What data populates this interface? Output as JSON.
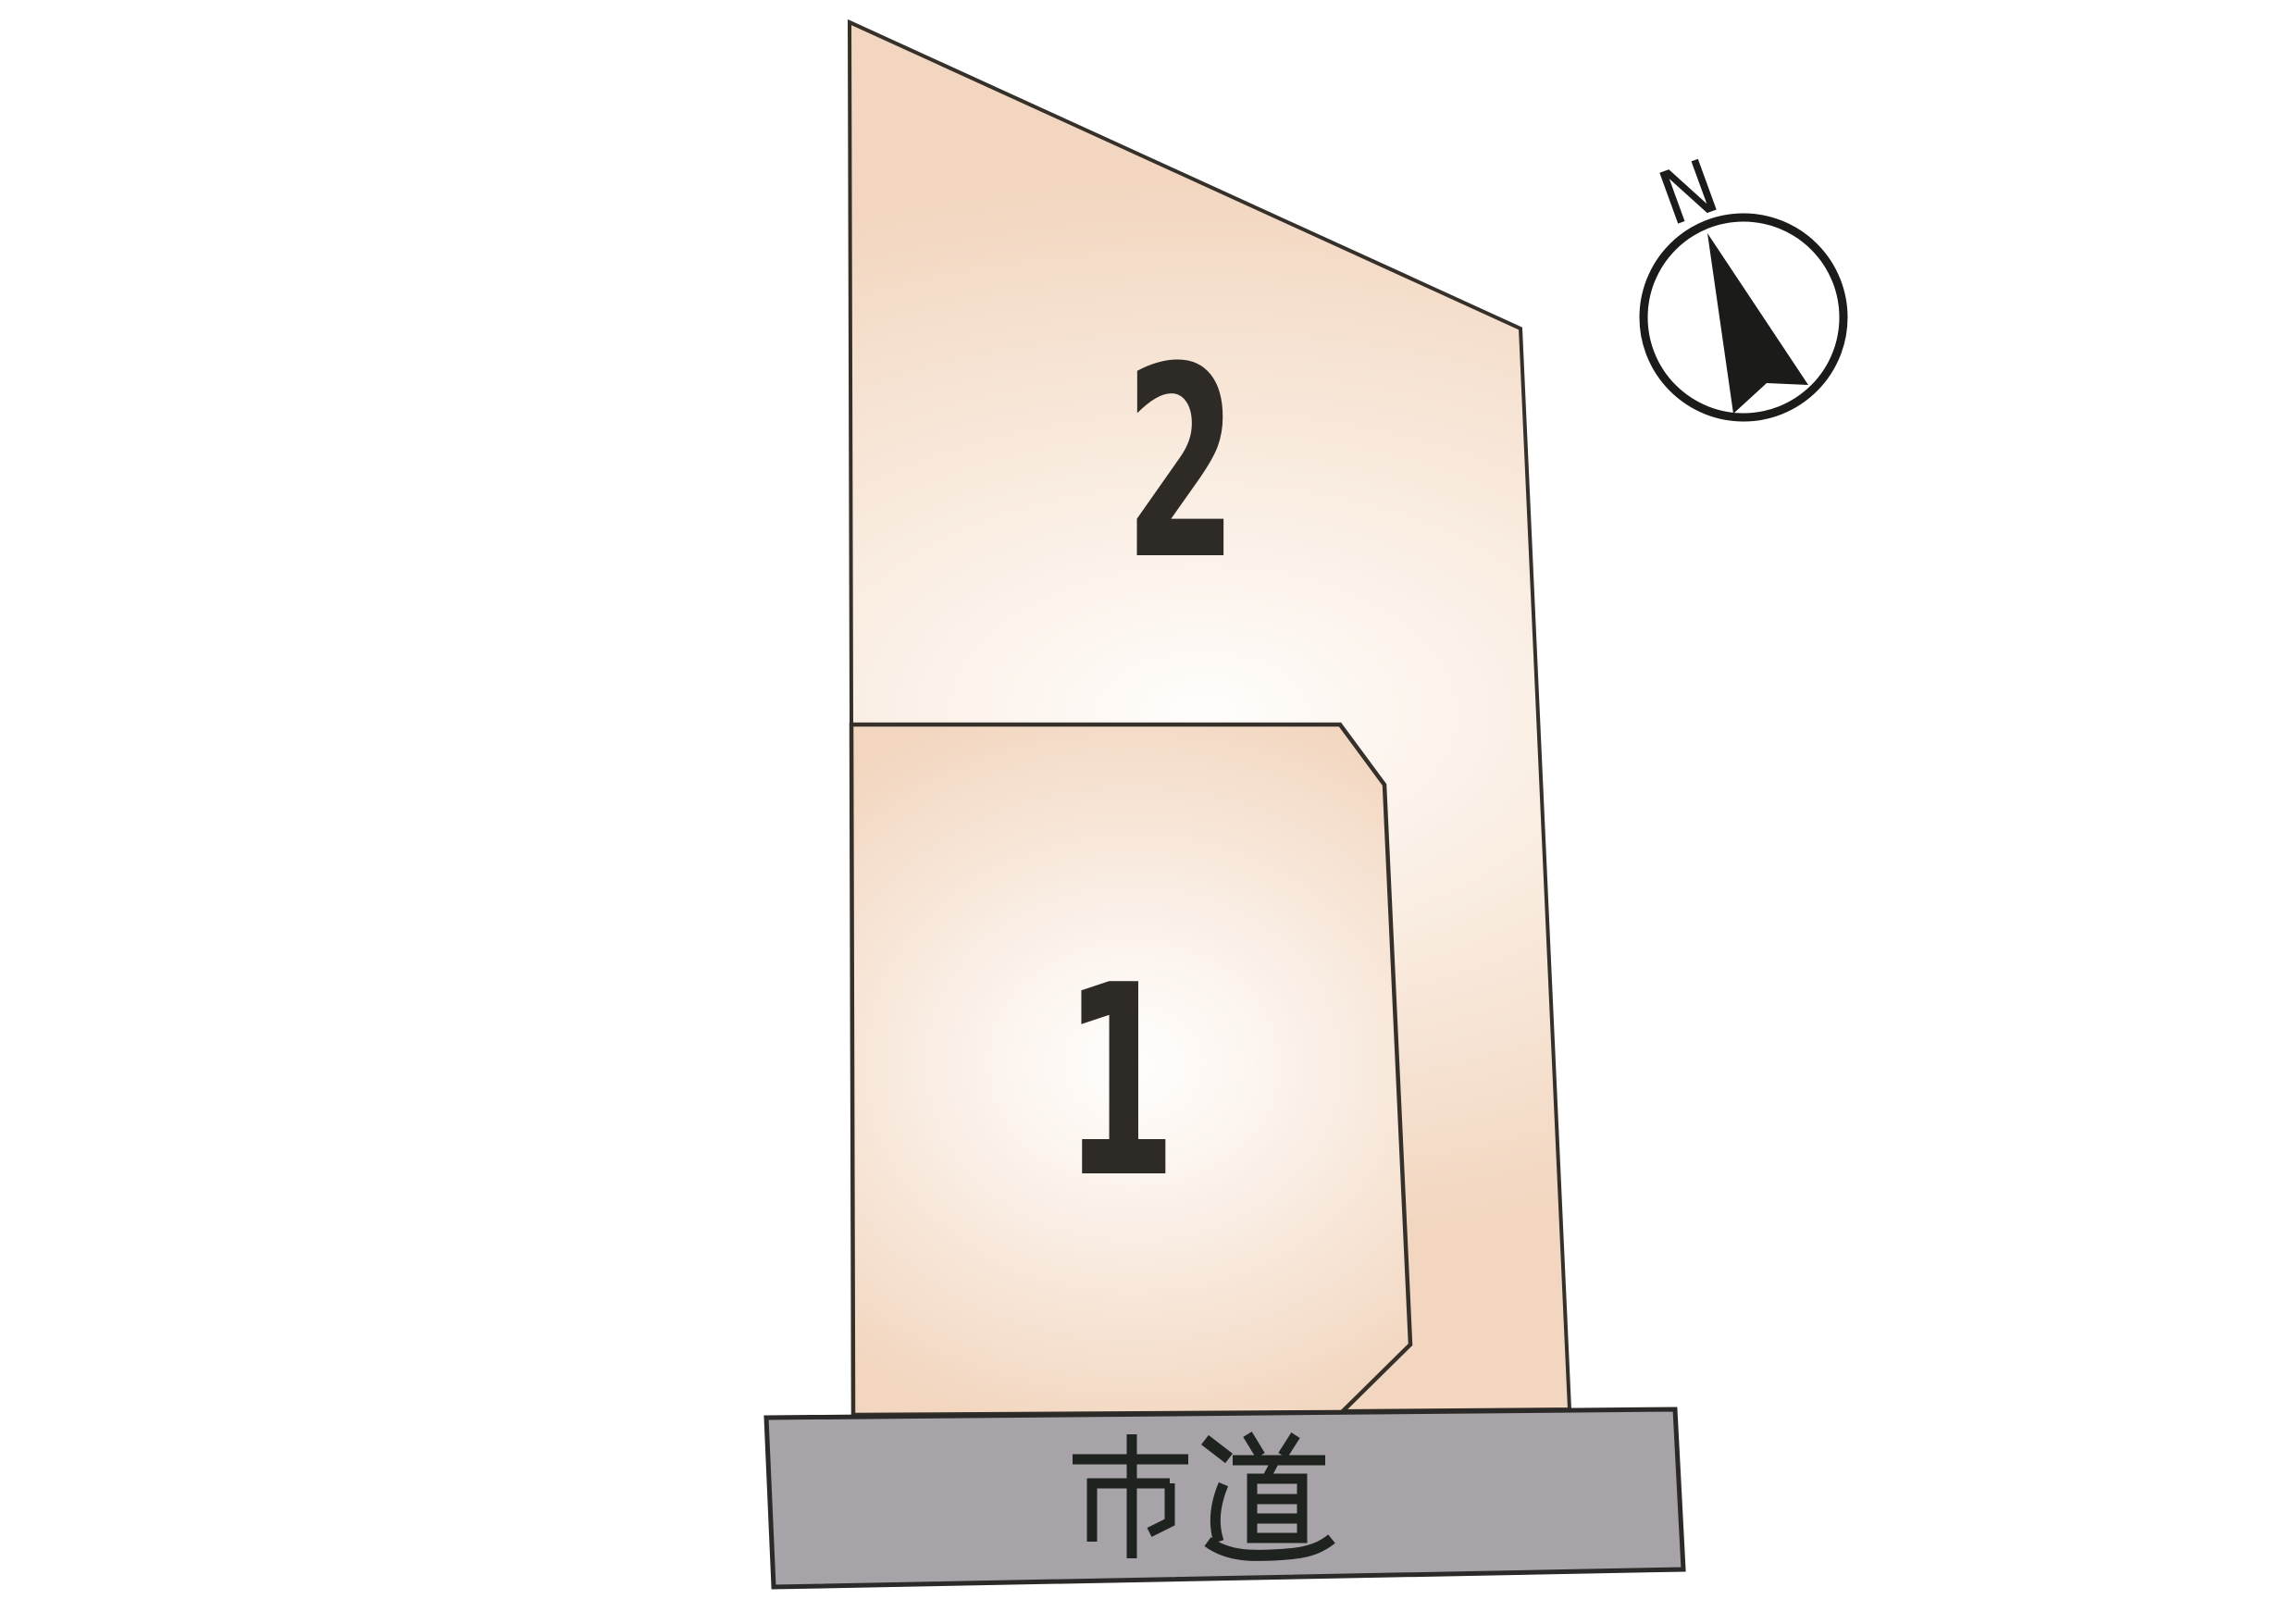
{
  "plan": {
    "description_visible_text_only": ""
  },
  "lots": [
    {
      "number": "2"
    },
    {
      "number": "1"
    }
  ],
  "road": {
    "label": "市道"
  },
  "compass": {
    "label": "N"
  },
  "colors": {
    "background": "#ffffff",
    "parcel_edge": "#f2d6bf",
    "parcel_mid": "#fbf1e8",
    "parcel_center": "#fffdfb",
    "lot1_center": "#fffefd",
    "lot1_mid": "#fcf4ee",
    "outline": "#35302a",
    "road_fill": "#a8a3a8",
    "road_outline": "#2b2a28",
    "number_color": "#2e2a26",
    "road_text_color": "#1e231f",
    "compass_color": "#1b1b19"
  }
}
